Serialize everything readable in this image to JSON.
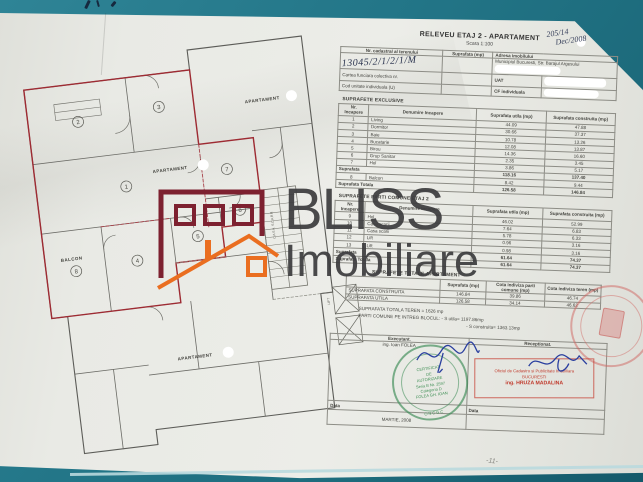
{
  "page": {
    "title": "RELEVEU ETAJ 2 - APARTAMENT",
    "scale": "Scara 1:100",
    "handwritten_note_line1": "205/14",
    "handwritten_note_line2": "Dec/2008",
    "page_number": "-11-"
  },
  "header_table": {
    "col_cadastral": "Nr. cadastral al terenului",
    "col_suprafata": "Suprafata (mp)",
    "col_adresa": "Adresa imobilului",
    "cadastral_number": "13045/2/1/2/1/M",
    "address": "Municipiul Bucuresti, Str. Barajul Argesului",
    "row_cartea": "Cartea funciara colectiva nr.",
    "row_uat": "UAT",
    "row_cod": "Cod unitate individuala (U)",
    "row_cf": "CF individuala"
  },
  "exclusive_table": {
    "title": "SUPRAFETE EXCLUSIVE",
    "headers": [
      "Nr. Incapere",
      "Denumire Incapere",
      "Suprafata utila (mp)",
      "Suprafata construita (mp)"
    ],
    "rows": [
      {
        "nr": "1",
        "name": "Living",
        "utila": "44.09",
        "constr": "47.88"
      },
      {
        "nr": "2",
        "name": "Dormitor",
        "utila": "30.66",
        "constr": "37.37"
      },
      {
        "nr": "3",
        "name": "Baie",
        "utila": "10.78",
        "constr": "13.26"
      },
      {
        "nr": "4",
        "name": "Bucatarie",
        "utila": "12.08",
        "constr": "13.87"
      },
      {
        "nr": "5",
        "name": "Birou",
        "utila": "14.36",
        "constr": "16.60"
      },
      {
        "nr": "6",
        "name": "Grup Sanitar",
        "utila": "2.35",
        "constr": "3.45"
      },
      {
        "nr": "7",
        "name": "Hol",
        "utila": "3.86",
        "constr": "5.17"
      }
    ],
    "subtotal_label": "Suprafata",
    "subtotal_utila": "118.16",
    "subtotal_constr": "137.40",
    "balcon_nr": "8",
    "balcon_name": "Balcon",
    "balcon_utila": "8.42",
    "balcon_constr": "9.44",
    "total_label": "Suprafata Totala",
    "total_utila": "126.58",
    "total_constr": "146.84"
  },
  "common_table": {
    "title": "SUPRAFETE PARTI COMUNE ETAJ 2",
    "headers": [
      "Nr. Incapere",
      "Denumire Incapere",
      "Suprafata utila (mp)",
      "Suprafata construita (mp)"
    ],
    "rows": [
      {
        "nr": "9",
        "name": "Hol",
        "utila": "46.02",
        "constr": "52.99"
      },
      {
        "nr": "10",
        "name": "Casa scarii",
        "utila": "7.64",
        "constr": "6.83"
      },
      {
        "nr": "11",
        "name": "Casa scarii",
        "utila": "5.78",
        "constr": "6.33"
      },
      {
        "nr": "12",
        "name": "Lift",
        "utila": "0.96",
        "constr": "3.16"
      },
      {
        "nr": "13",
        "name": "Lift",
        "utila": "0.98",
        "constr": "3.16"
      }
    ],
    "subtotal_label": "Suprafata",
    "subtotal_utila": "61.64",
    "subtotal_constr": "74.37",
    "total_label": "Suprafata Totala",
    "total_utila": "61.64",
    "total_constr": "74.37"
  },
  "totals_table": {
    "title": "SUPRAFETE TOTALE APARTAMENT",
    "col_suprafata": "Suprafata (mp)",
    "col_cota_comune": "Cota indiviza parti comune (mp)",
    "col_cota_teren": "Cota indiviza teren (mp)",
    "row1_label": "SUPRAFATA CONSTRUITA",
    "row1_s": "146.84",
    "row1_cc": "39.86",
    "row1_ct": "46.74",
    "row2_label": "SUPRAFATA UTILA",
    "row2_s": "126.58",
    "row2_cc": "34.14",
    "row2_ct": "46.62"
  },
  "notes": {
    "line1": "SUPRAFATA TOTALA TEREN = 1626 mp",
    "line2": "PARTI COMUNE PE INTREG BLOCUL: - S utila= 1197.86mp",
    "line3": "- S construita= 1363.13mp"
  },
  "signoff": {
    "executant_label": "Executant.",
    "receptionat_label": "Receptionat.",
    "executant_name": "ing. Ioan FOLEA",
    "data_label": "Data",
    "date_value": "MARTIE, 2008",
    "green_stamp": {
      "l1": "CERTIFICAT",
      "l2": "DE",
      "l3": "AUTORIZARE",
      "l4": "Seria B Nr. 2597",
      "l5": "Categoria D",
      "l6": "FOLEA GH. IOAN",
      "l7": "ONCGC"
    },
    "red_stamp": {
      "l1": "Oficiul de Cadastru si Publicitate Imobiliara",
      "l2": "BUCURESTI",
      "l3": "ing. HRUZA MADALINA"
    }
  },
  "logo": {
    "name": "BLISS",
    "sub": "Imobiliare",
    "maroon": "#7d2130",
    "orange": "#ea6e20",
    "text_color": "#3d3d3f"
  },
  "plan": {
    "label_apartament": "APARTAMENT",
    "label_balcon": "BALCON",
    "label_casa_scarii": "CASA SCARII",
    "label_lift": "LIFT",
    "room_numbers": [
      "1",
      "2",
      "3",
      "4",
      "5",
      "6",
      "7",
      "8"
    ]
  }
}
